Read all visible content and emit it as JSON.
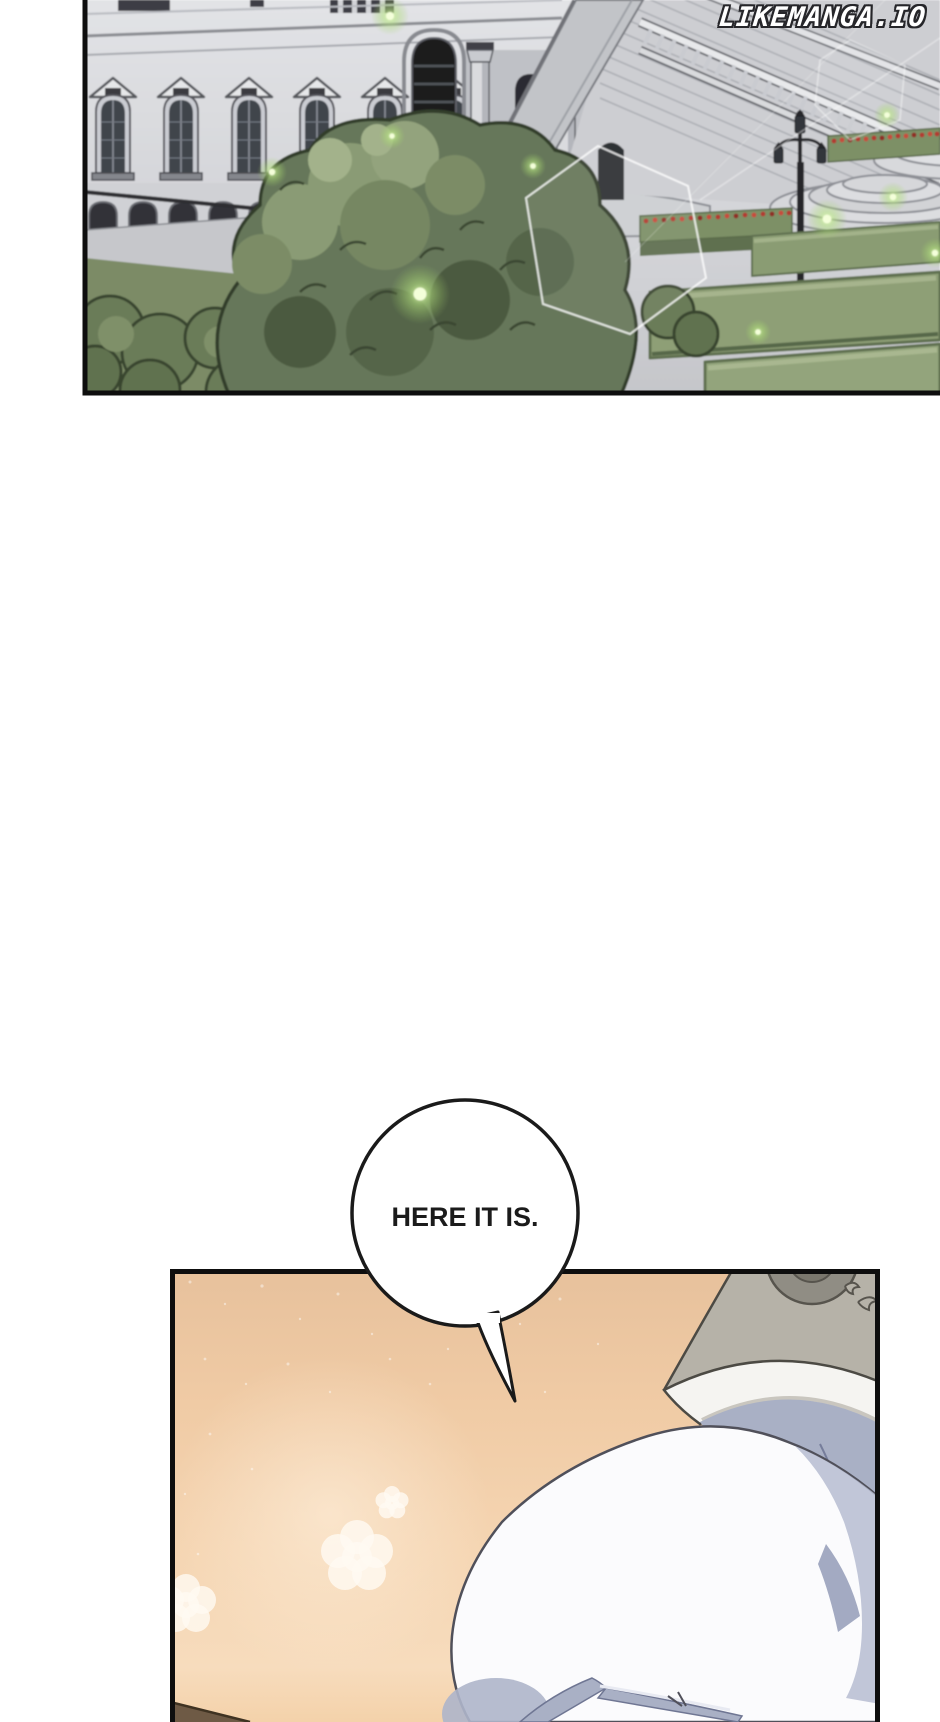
{
  "watermark": {
    "text": "LIKEMANGA.IO"
  },
  "speech_bubble": {
    "text": "HERE IT IS."
  },
  "colors": {
    "page_background": "#ffffff",
    "panel_border": "#0e0e0e",
    "stone_light": "#dcdde0",
    "stone_shadow": "#b9bcc3",
    "window_glass": "#41454c",
    "path_grey": "#c6c7cb",
    "bush_base": "#66775a",
    "bush_outline": "#333d2c",
    "bush_highlight": "#a3b28b",
    "lawn_green": "#7b8b66",
    "hedge_green": "#7d9066",
    "flower_red": "#b23b30",
    "firefly_glow": "#b5e47f",
    "firefly_core": "#f4ffda",
    "barrier_outline": "rgba(255,255,255,0.8)",
    "peach_top": "#e7c19c",
    "peach_bottom": "#f7dcbd",
    "fabric_grey_beige": "#b6b2a8",
    "fabric_blue_grey": "#a9b0c5",
    "sleeve_white": "#f5f4f1",
    "glove_white": "#fbfbfd",
    "glove_shadow": "#b6bcd1",
    "skin_tone": "#f1d0a8",
    "bubble_fill": "#ffffff",
    "bubble_stroke": "#1a1a1a",
    "text_dark": "#1b1b1b"
  }
}
